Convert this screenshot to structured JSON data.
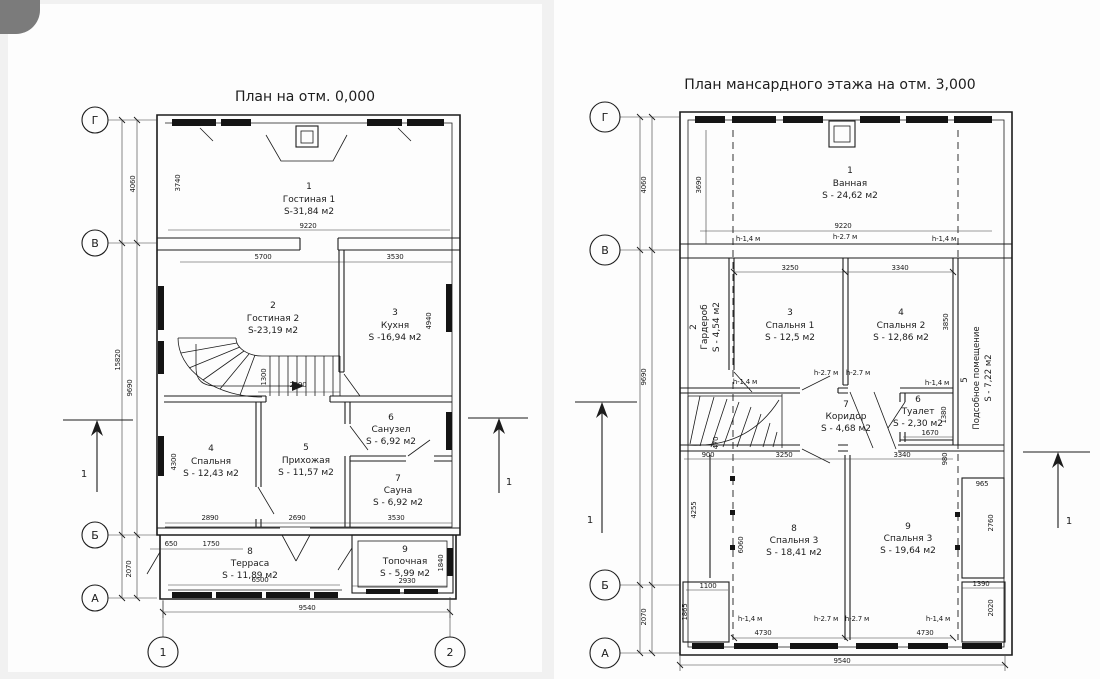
{
  "left_plan": {
    "title": "План на отм. 0,000",
    "axes": {
      "rows": [
        "Г",
        "В",
        "Б",
        "А"
      ],
      "cols": [
        "1",
        "2"
      ]
    },
    "section_label": "1",
    "rooms": [
      {
        "num": "1",
        "name": "Гостиная 1",
        "area": "S-31,84 м2"
      },
      {
        "num": "2",
        "name": "Гостиная 2",
        "area": "S-23,19 м2"
      },
      {
        "num": "3",
        "name": "Кухня",
        "area": "S -16,94 м2"
      },
      {
        "num": "4",
        "name": "Спальня",
        "area": "S - 12,43 м2"
      },
      {
        "num": "5",
        "name": "Прихожая",
        "area": "S - 11,57 м2"
      },
      {
        "num": "6",
        "name": "Санузел",
        "area": "S - 6,92 м2"
      },
      {
        "num": "7",
        "name": "Сауна",
        "area": "S - 6,92 м2"
      },
      {
        "num": "8",
        "name": "Терраса",
        "area": "S - 11,89 м2"
      },
      {
        "num": "9",
        "name": "Топочная",
        "area": "S - 5,99 м2"
      }
    ],
    "dims": {
      "v15820": "15820",
      "v4060": "4060",
      "v9690": "9690",
      "v2070": "2070",
      "v3740": "3740",
      "h9220": "9220",
      "h5700": "5700",
      "h3530_top": "3530",
      "v4940": "4940",
      "h2690_mid": "2690",
      "v1300": "1300",
      "h2890": "2890",
      "h2690_bot": "2690",
      "h3530_bot": "3530",
      "v4300": "4300",
      "h650": "650",
      "h1750": "1750",
      "h6500": "6500",
      "h2930": "2930",
      "v1840": "1840",
      "h9540": "9540"
    }
  },
  "right_plan": {
    "title": "План мансардного этажа на отм. 3,000",
    "axes": {
      "rows": [
        "Г",
        "В",
        "Б",
        "А"
      ]
    },
    "section_label": "1",
    "heights": {
      "low": "h-1,4 м",
      "high": "h-2.7 м"
    },
    "rooms": [
      {
        "num": "1",
        "name": "Ванная",
        "area": "S - 24,62 м2"
      },
      {
        "num": "2",
        "name": "Гардероб",
        "area": "S - 4,54 м2"
      },
      {
        "num": "3",
        "name": "Спальня 1",
        "area": "S - 12,5 м2"
      },
      {
        "num": "4",
        "name": "Спальня 2",
        "area": "S - 12,86 м2"
      },
      {
        "num": "5",
        "name": "Подсобное помещение",
        "area": "S - 7,22 м2"
      },
      {
        "num": "6",
        "name": "Туалет",
        "area": "S - 2,30 м2"
      },
      {
        "num": "7",
        "name": "Коридор",
        "area": "S - 4,68 м2"
      },
      {
        "num": "8",
        "name": "Спальня 3",
        "area": "S - 18,41 м2"
      },
      {
        "num": "9",
        "name": "Спальня 3",
        "area": "S - 19,64 м2"
      }
    ],
    "dims": {
      "v4060": "4060",
      "v3690": "3690",
      "v9690": "9690",
      "v2070": "2070",
      "h9220": "9220",
      "h3250_top": "3250",
      "h3340_top": "3340",
      "v3850": "3850",
      "v1380": "1380",
      "h1670": "1670",
      "v470": "470",
      "h900": "900",
      "h3250_bot": "3250",
      "h3340_bot": "3340",
      "v980": "980",
      "h965": "965",
      "v2760": "2760",
      "v4255": "4255",
      "v6060": "6060",
      "h1100": "1100",
      "v1865": "1865",
      "h1390": "1390",
      "v2020": "2020",
      "h4730_left": "4730",
      "h4730_right": "4730",
      "h9540": "9540"
    }
  }
}
